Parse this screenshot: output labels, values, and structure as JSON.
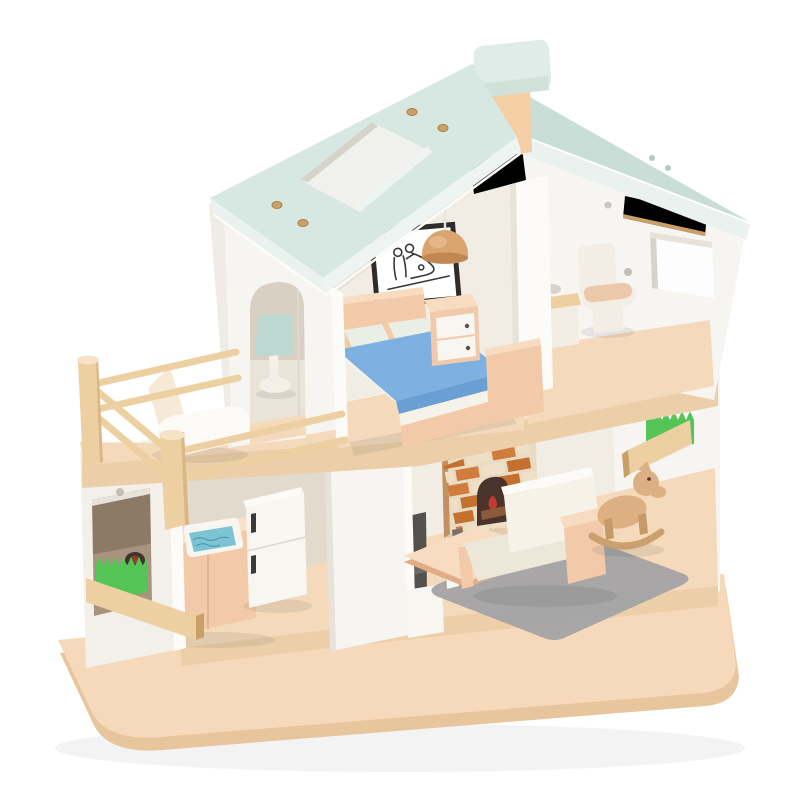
{
  "meta": {
    "type": "product-photograph",
    "subject": "two-story wooden dollhouse toy with furniture",
    "background": "#ffffff"
  },
  "palette": {
    "bg": "#ffffff",
    "base-top": "#f5d9ba",
    "base-side": "#e7c69e",
    "floor": "#f4d9bb",
    "floor-edge": "#eccfa9",
    "wood-light": "#f7e2c7",
    "wood": "#ecd0a2",
    "wood-dark": "#d9b783",
    "beam": "#e5c röda08f",
    "beam-dark": "#c9a066",
    "wall-white": "#f7f5f1",
    "wall-bright": "#fcfbf8",
    "wall-soft": "#f3f0ea",
    "wall-shade": "#e7e3db",
    "interior": "#f1ede5",
    "interior-shade": "#e2dacd",
    "kitchen-dark": "#a8947e",
    "kitchen-darker": "#8d7a66",
    "roof": "#d7e8e2",
    "roof-dark": "#c9ded7",
    "roof-edge": "#e9f2ef",
    "roof-edge2": "#eef4f1",
    "mint-cap": "#dfece7",
    "mint-cap-dark": "#d0e1da",
    "chimney": "#f4cfa6",
    "skylight-in": "#f0f0ed",
    "skylight-shade": "#d6d3cb",
    "screw": "#c9a168",
    "screw-dark": "#a87f4a",
    "pink": "#f2c9a9",
    "pink-light": "#f8dcc2",
    "pink-dark": "#e0ad87",
    "drawer": "#f8f6f1",
    "knob": "#5a5248",
    "blanket": "#7fb1e0",
    "blanket-dark": "#699fd3",
    "pillow": "#e9efe4",
    "sheet": "#f5f2ea",
    "mint-lamp": "#bcd8d0",
    "lamp-base": "#f4efe8",
    "wood-lamp": "#d9a46f",
    "wood-lamp-dark": "#c08752",
    "cord": "#e9e5de",
    "frame-black": "#2e2c2a",
    "art-line": "#3a3836",
    "grass": "#55c457",
    "grass-dark": "#3da344",
    "sink-blue": "#7cc4d4",
    "sink-pattern": "#3f8fa6",
    "steel-dark": "#3a3a3a",
    "stove-ring": "#8f3e2d",
    "stove-dark": "#3e332c",
    "cream": "#f2eee5",
    "toilet-lid": "#ecc8ab",
    "sofa": "#f6f2e8",
    "sofa-shade": "#ece7d9",
    "rug": "#a3a3a5",
    "brick-a": "#d07c3c",
    "brick-b": "#eee0c6",
    "brick-c": "#c4702f",
    "fire-body": "#d9a87e",
    "fire-side": "#c39062",
    "fire-dark": "#4a332a",
    "log": "#8a5a3a",
    "flame": "#c33b2f",
    "horse": "#dcb083",
    "horse-dark": "#c69a68",
    "tv": "#54504e",
    "tv-light": "#6e6a67",
    "dot": "#9a9184"
  },
  "scene": {
    "base": [
      "wooden-base-board"
    ],
    "roof": [
      "left-panel",
      "right-panel",
      "skylight",
      "gold-screws",
      "chimney"
    ],
    "balcony": [
      "wood-railing",
      "lounge-chair"
    ],
    "bedroom": [
      "wall-art-frame",
      "pendant-lamp",
      "bed",
      "pillows",
      "blue-blanket",
      "dresser",
      "arched-doorway",
      "table-lamp"
    ],
    "bathroom": [
      "toilet",
      "sink-vanity",
      "gable-window",
      "roof-beam"
    ],
    "kitchen": [
      "front-wall-window",
      "grass-planter",
      "counter",
      "stove",
      "blue-sink",
      "fridge"
    ],
    "living-room": [
      "fireplace",
      "tv",
      "coffee-table",
      "sofa",
      "gray-rug",
      "rocking-horse",
      "side-window-planter"
    ]
  }
}
